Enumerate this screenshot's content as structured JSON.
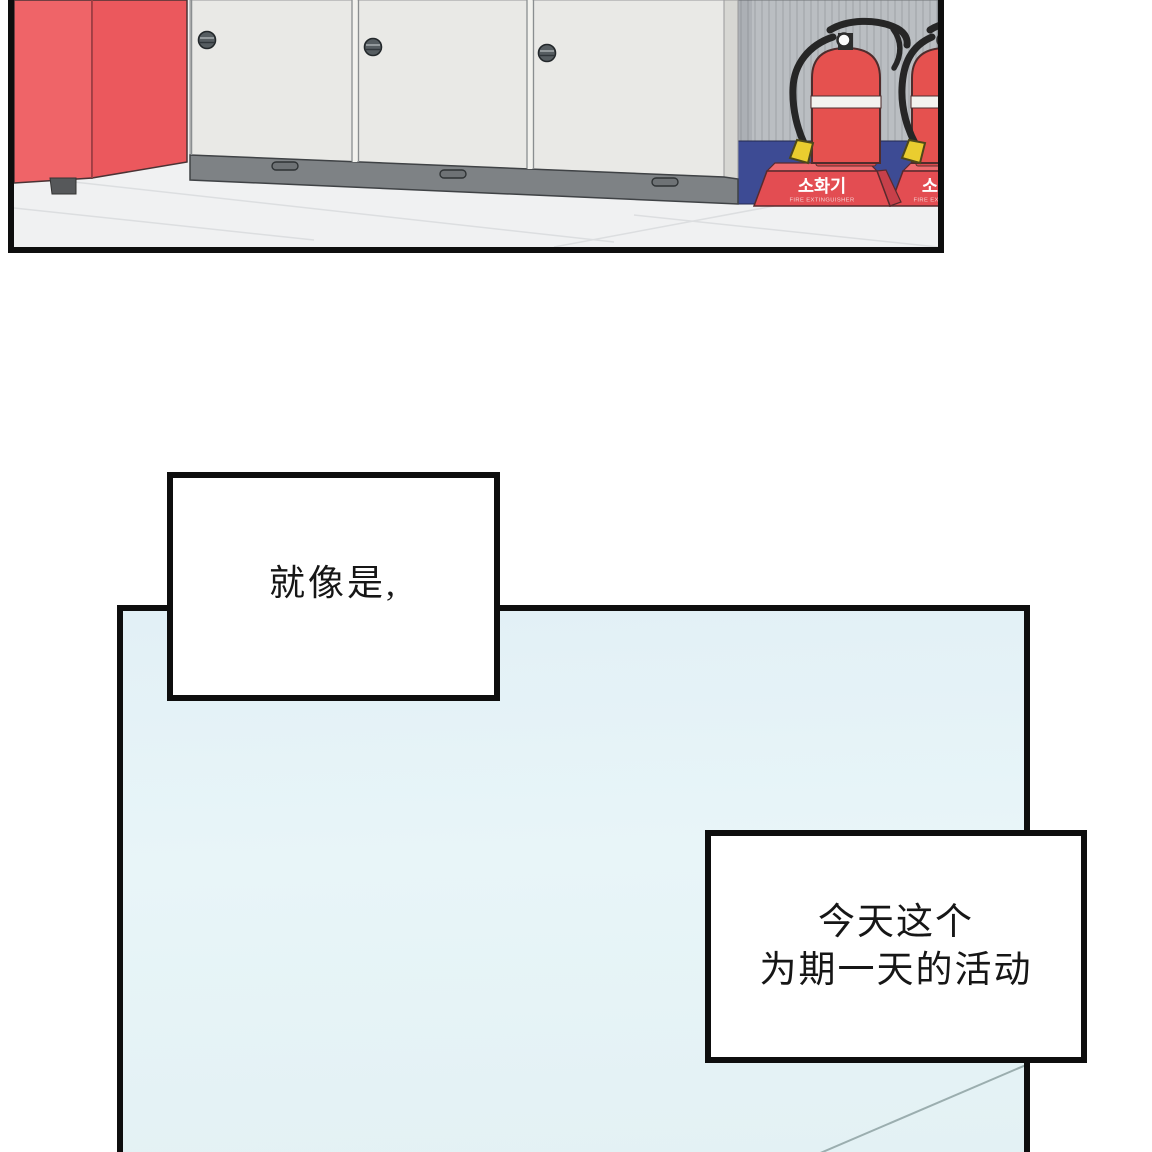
{
  "colors": {
    "page_background": "#ffffff",
    "panel_border": "#0e0e0e",
    "machine_red_front": "#ef6468",
    "machine_red_side": "#eb585d",
    "locker_body": "#e9e9e6",
    "locker_plinth": "#7e8285",
    "knob_gray": "#565d61",
    "wall_gray": "#babec2",
    "wall_stripe": "#a9adb1",
    "baseboard_navy": "#3d4b94",
    "extinguisher_red": "#e5514f",
    "stand_red_front": "#e34d52",
    "stand_red_top": "#ef6b6f",
    "stand_red_side": "#c7404a",
    "hose_black": "#262626",
    "nozzle_yellow": "#eacd2f",
    "floor_gray": "#f0f1f2",
    "blue_panel_fill": "#e5f3f7",
    "caption_text": "#161616"
  },
  "scene": {
    "stand_label_ko": "소화기",
    "stand_label_en": "FIRE EXTINGUISHER"
  },
  "captions": {
    "caption1": {
      "text": "就像是,"
    },
    "caption2": {
      "line1": "今天这个",
      "line2": "为期一天的活动"
    }
  }
}
